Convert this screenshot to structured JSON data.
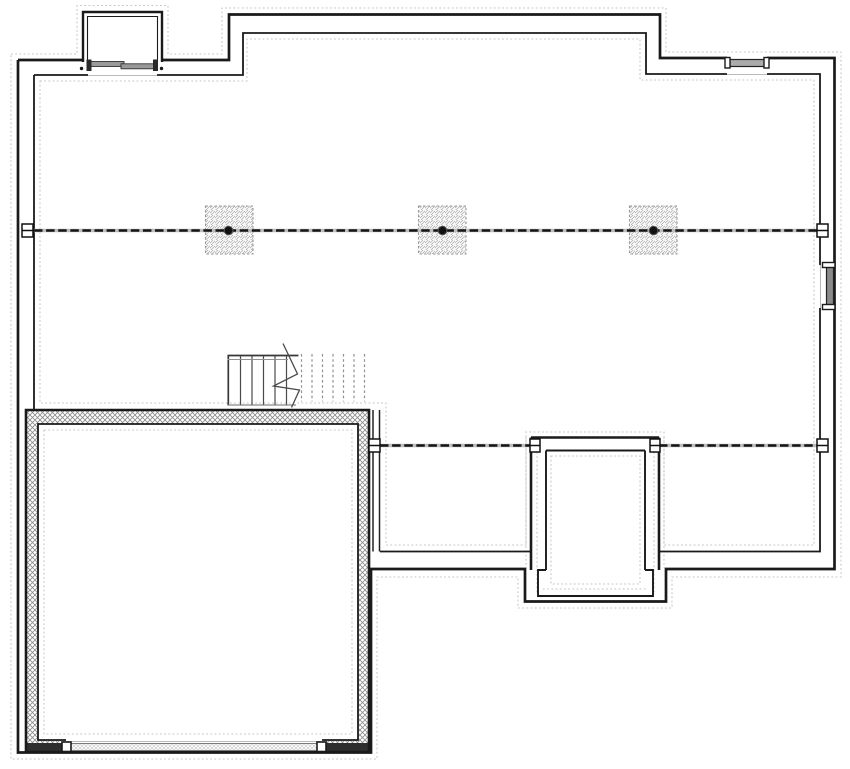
{
  "meta": {
    "title": "basement-foundation-plan",
    "canvas": {
      "width": 850,
      "height": 769
    },
    "background": "#ffffff"
  },
  "palette": {
    "ink": "#1a1a1a",
    "beam_dash": "#141414",
    "beam_under": "#bdbdbd",
    "footing": "#c6c6c6",
    "opening_line": "#bbbbbb",
    "hatch_dark": "#8a8a8a",
    "hatch_light": "#b5b5b5",
    "white": "#ffffff"
  },
  "plan": {
    "shapes": [
      {
        "name": "footing-outer",
        "type": "path",
        "d": "M11,54 H77 V5.5 H168 V54 H222 V8 H666 V52 H841 V577 H672 V608 H518 V577 H377 V759 H11 Z",
        "stroke": "#c6c6c6",
        "sw": 1.1,
        "dash": "1.8 2.4",
        "fill": "none"
      },
      {
        "name": "footing-inner",
        "type": "path",
        "d": "M40,81 H247 V39 H640 V80 H814 V545 H664 V432 H526 V545 H386 V403 H40 Z",
        "stroke": "#c6c6c6",
        "sw": 1.1,
        "dash": "1.8 2.4",
        "fill": "none"
      },
      {
        "name": "footing-garage",
        "type": "path",
        "d": "M44,430 H352 V734 H44 Z",
        "stroke": "#c6c6c6",
        "sw": 1.1,
        "dash": "1.8 2.4",
        "fill": "none"
      },
      {
        "name": "footing-stoop-inner",
        "type": "path",
        "d": "M551,456 H640 V584 H551 Z M543,589 H648",
        "stroke": "#c6c6c6",
        "sw": 1.1,
        "dash": "1.8 2.4",
        "fill": "none"
      },
      {
        "name": "footing-stoop-walls",
        "type": "path",
        "d": "M537,452 V593 M654,452 V593 M526,437 V568 M664,437 V568",
        "stroke": "#c6c6c6",
        "sw": 1.1,
        "dash": "1.8 2.4",
        "fill": "none"
      },
      {
        "name": "garage-wall-hatch",
        "type": "path",
        "d": "M26,410 H369 V752 H26 Z M38,424 H358 V740 H38 Z",
        "fill": "url(#hatch-wall)",
        "fr": "evenodd",
        "stroke": "none"
      },
      {
        "name": "garage-door-flank-left",
        "type": "path",
        "d": "M26,743 H68 V752 H26 Z",
        "fill": "#2e2e2e",
        "stroke": "none"
      },
      {
        "name": "garage-door-flank-right",
        "type": "path",
        "d": "M320,743 H369 V752 H320 Z",
        "fill": "#2e2e2e",
        "stroke": "none"
      },
      {
        "name": "garage-wall-outer-line",
        "type": "path",
        "d": "M26,410 H369 V752 H26 Z",
        "stroke": "#1a1a1a",
        "sw": 2.6,
        "fill": "none"
      },
      {
        "name": "garage-wall-inner-line",
        "type": "path",
        "d": "M38,424 H358 V740 H38 Z",
        "stroke": "#1a1a1a",
        "sw": 1.8,
        "fill": "none"
      },
      {
        "name": "garage-door-clear",
        "type": "rect",
        "x": 66,
        "y": 738.5,
        "w": 256,
        "h": 12,
        "fill": "#ffffff",
        "stroke": "none"
      },
      {
        "name": "garage-door-sill-line",
        "type": "line",
        "x1": 66,
        "y1": 741.5,
        "x2": 322,
        "y2": 741.5,
        "stroke": "#bbbbbb",
        "sw": 1,
        "fill": "none"
      },
      {
        "name": "garage-door-panel",
        "type": "rect",
        "x": 70,
        "y": 743.5,
        "w": 248,
        "h": 7,
        "fill": "url(#hatch-door)",
        "stroke": "#7a7a7a",
        "sw": 1
      },
      {
        "name": "garage-door-jamb-left",
        "type": "rect",
        "x": 62,
        "y": 742,
        "w": 9,
        "h": 9.5,
        "fill": "#ffffff",
        "stroke": "#1a1a1a",
        "sw": 1.6
      },
      {
        "name": "garage-door-jamb-right",
        "type": "rect",
        "x": 317,
        "y": 742,
        "w": 9,
        "h": 9.5,
        "fill": "#ffffff",
        "stroke": "#1a1a1a",
        "sw": 1.6
      },
      {
        "name": "exterior-wall-outer",
        "type": "path",
        "d": "M18,60 H83 M162,60 H229 V14.5 H660 V58 H727 M767,58 H834.5 V569 H666 V601.5 H525 V569 H371 V752.5 H18 V60",
        "stroke": "#1a1a1a",
        "sw": 2.7,
        "fill": "none"
      },
      {
        "name": "exterior-wall-inner",
        "type": "path",
        "d": "M34,75 V410 M34,75 H88 M157,75 H243 V33 H646 V74 H727 M767,74 H820 V265 M820,308 V551.5 H659 M531,551.5 H380",
        "stroke": "#1a1a1a",
        "sw": 1.8,
        "fill": "none"
      },
      {
        "name": "garage-frame-wall",
        "type": "path",
        "d": "M373,410 V551.5 M379.5,410 V551.5",
        "stroke": "#222222",
        "sw": 1.5,
        "fill": "none"
      },
      {
        "name": "stoop-wall-outer",
        "type": "path",
        "d": "M531,437.5 H659 M531,437.5 V570 M659,437.5 V570",
        "stroke": "#1a1a1a",
        "sw": 2.6,
        "fill": "none"
      },
      {
        "name": "stoop-wall-inner",
        "type": "path",
        "d": "M546,450.5 H645 M546,450.5 V570 M645,450.5 V570 M546,570 H538 V596 H653 V570 H645",
        "stroke": "#1a1a1a",
        "sw": 1.9,
        "fill": "none"
      },
      {
        "name": "window-well-outline-outer",
        "type": "path",
        "d": "M83,62 V12 H162 V62",
        "stroke": "#1a1a1a",
        "sw": 2.4,
        "fill": "#ffffff"
      },
      {
        "name": "window-well-outline-inner",
        "type": "path",
        "d": "M87.5,62 V16.5 H157.5 V62",
        "stroke": "#1a1a1a",
        "sw": 1.1,
        "fill": "none"
      },
      {
        "name": "window-well-sill-line",
        "type": "line",
        "x1": 88,
        "y1": 75.5,
        "x2": 157,
        "y2": 75.5,
        "stroke": "#bbbbbb",
        "sw": 1.1,
        "fill": "none"
      },
      {
        "name": "well-window-sash-left",
        "type": "rect",
        "x": 90.5,
        "y": 61.5,
        "w": 33.5,
        "h": 5,
        "fill": "#9a9a9a",
        "stroke": "#333333",
        "sw": 0.9
      },
      {
        "name": "well-window-sash-right",
        "type": "rect",
        "x": 121,
        "y": 63.8,
        "w": 33.5,
        "h": 5,
        "fill": "#9a9a9a",
        "stroke": "#333333",
        "sw": 0.9
      },
      {
        "name": "well-window-jamb-left",
        "type": "rect",
        "x": 86.5,
        "y": 59.5,
        "w": 5,
        "h": 11.5,
        "fill": "#2a2a2a",
        "stroke": "none"
      },
      {
        "name": "well-window-jamb-right",
        "type": "rect",
        "x": 153,
        "y": 59.5,
        "w": 5,
        "h": 11.5,
        "fill": "#2a2a2a",
        "stroke": "none"
      },
      {
        "name": "well-marker-dot-left",
        "type": "circle",
        "cx": 81.5,
        "cy": 68.5,
        "r": 1.7,
        "fill": "#1a1a1a",
        "stroke": "none"
      },
      {
        "name": "well-marker-dot-right",
        "type": "circle",
        "cx": 161.5,
        "cy": 68.5,
        "r": 1.7,
        "fill": "#1a1a1a",
        "stroke": "none"
      },
      {
        "name": "window-top-sill-line",
        "type": "line",
        "x1": 727,
        "y1": 74.5,
        "x2": 767,
        "y2": 74.5,
        "stroke": "#bbbbbb",
        "sw": 1.1,
        "fill": "none"
      },
      {
        "name": "window-top-bar",
        "type": "rect",
        "x": 727,
        "y": 59.5,
        "w": 40,
        "h": 7,
        "fill": "#ababab",
        "stroke": "#222222",
        "sw": 1.2
      },
      {
        "name": "window-top-cap-left",
        "type": "rect",
        "x": 725,
        "y": 57.5,
        "w": 5,
        "h": 10.5,
        "fill": "#ffffff",
        "stroke": "#1a1a1a",
        "sw": 1.4
      },
      {
        "name": "window-top-cap-right",
        "type": "rect",
        "x": 764,
        "y": 57.5,
        "w": 5,
        "h": 10.5,
        "fill": "#ffffff",
        "stroke": "#1a1a1a",
        "sw": 1.4
      },
      {
        "name": "window-right-sill-line",
        "type": "line",
        "x1": 820.5,
        "y1": 265,
        "x2": 820.5,
        "y2": 308,
        "stroke": "#bbbbbb",
        "sw": 1.1,
        "fill": "none"
      },
      {
        "name": "window-right-bar",
        "type": "rect",
        "x": 826.5,
        "y": 266.5,
        "w": 7,
        "h": 40.5,
        "fill": "#8a8a8a",
        "stroke": "#222222",
        "sw": 1.2
      },
      {
        "name": "window-right-cap-top",
        "type": "rect",
        "x": 822.5,
        "y": 262.5,
        "w": 12.5,
        "h": 5,
        "fill": "#ffffff",
        "stroke": "#1a1a1a",
        "sw": 1.4
      },
      {
        "name": "window-right-cap-bottom",
        "type": "rect",
        "x": 822.5,
        "y": 304.5,
        "w": 12.5,
        "h": 5,
        "fill": "#ffffff",
        "stroke": "#1a1a1a",
        "sw": 1.4
      },
      {
        "name": "column-pad-1",
        "type": "rect",
        "x": 205.5,
        "y": 206,
        "w": 47.5,
        "h": 48,
        "fill": "url(#hatch-col)",
        "stroke": "#9a9a9a",
        "sw": 1.1,
        "dash": "2.5 2"
      },
      {
        "name": "column-pad-2",
        "type": "rect",
        "x": 418.5,
        "y": 206,
        "w": 47.5,
        "h": 48,
        "fill": "url(#hatch-col)",
        "stroke": "#9a9a9a",
        "sw": 1.1,
        "dash": "2.5 2"
      },
      {
        "name": "column-pad-3",
        "type": "rect",
        "x": 629.5,
        "y": 206,
        "w": 47.5,
        "h": 48,
        "fill": "url(#hatch-col)",
        "stroke": "#9a9a9a",
        "sw": 1.1,
        "dash": "2.5 2"
      },
      {
        "name": "beam-main-underlay",
        "type": "line",
        "x1": 34,
        "y1": 230.5,
        "x2": 820,
        "y2": 230.5,
        "stroke": "#bdbdbd",
        "sw": 3.4,
        "fill": "none"
      },
      {
        "name": "beam-main",
        "type": "line",
        "x1": 34,
        "y1": 230.5,
        "x2": 820,
        "y2": 230.5,
        "stroke": "#141414",
        "sw": 2.6,
        "dash": "8.5 3.6",
        "fill": "none"
      },
      {
        "name": "beam-rear-underlay",
        "type": "path",
        "d": "M380,445.5 H531 M659,445.5 H818",
        "stroke": "#bdbdbd",
        "sw": 3.4,
        "fill": "none"
      },
      {
        "name": "beam-rear",
        "type": "path",
        "d": "M380,445.5 H531 M659,445.5 H818",
        "stroke": "#141414",
        "sw": 2.6,
        "dash": "8.5 3.6",
        "fill": "none"
      },
      {
        "name": "column-post-1",
        "type": "circle",
        "cx": 228.5,
        "cy": 230.5,
        "r": 4.3,
        "fill": "#111111",
        "stroke": "#555555",
        "sw": 1
      },
      {
        "name": "column-post-2",
        "type": "circle",
        "cx": 442.5,
        "cy": 230.5,
        "r": 4.3,
        "fill": "#111111",
        "stroke": "#555555",
        "sw": 1
      },
      {
        "name": "column-post-3",
        "type": "circle",
        "cx": 653.5,
        "cy": 230.5,
        "r": 4.3,
        "fill": "#111111",
        "stroke": "#555555",
        "sw": 1
      },
      {
        "name": "beam-plate-main-left",
        "type": "path",
        "d": "M22,224 H33 V237 H22 Z M22,230.5 H33",
        "stroke": "#111111",
        "sw": 1.5,
        "fill": "#ffffff"
      },
      {
        "name": "beam-plate-main-right",
        "type": "path",
        "d": "M817,224 H828 V237 H817 Z M817,230.5 H828",
        "stroke": "#111111",
        "sw": 1.5,
        "fill": "#ffffff"
      },
      {
        "name": "beam-plate-rear-garage",
        "type": "path",
        "d": "M369,439 H380 V452 H369 Z M369,445.5 H380",
        "stroke": "#111111",
        "sw": 1.5,
        "fill": "#ffffff"
      },
      {
        "name": "beam-plate-stoop-left",
        "type": "path",
        "d": "M530,439 H540 V452 H530 Z M530,445.5 H540",
        "stroke": "#111111",
        "sw": 1.5,
        "fill": "#ffffff"
      },
      {
        "name": "beam-plate-stoop-right",
        "type": "path",
        "d": "M650,439 H660 V452 H650 Z M650,445.5 H660",
        "stroke": "#111111",
        "sw": 1.5,
        "fill": "#ffffff"
      },
      {
        "name": "beam-plate-rear-right",
        "type": "path",
        "d": "M817,439 H828 V452 H817 Z M817,445.5 H828",
        "stroke": "#111111",
        "sw": 1.5,
        "fill": "#ffffff"
      },
      {
        "name": "stair-treads",
        "type": "path",
        "d": "M240.5,356 V405 M252,356 V405 M263.5,356 V405 M275,356 V405 M286.5,356 V405",
        "stroke": "#4a4a4a",
        "sw": 1.2,
        "fill": "none"
      },
      {
        "name": "stair-top-edge",
        "type": "path",
        "d": "M227.5,355.5 H298.5 M228.3,355.5 V405.5",
        "stroke": "#383838",
        "sw": 1.7,
        "fill": "none"
      },
      {
        "name": "stair-top-edge-inner",
        "type": "line",
        "x1": 227.5,
        "y1": 359.5,
        "x2": 288,
        "y2": 359.5,
        "stroke": "#909090",
        "sw": 0.9,
        "fill": "none"
      },
      {
        "name": "stair-bottom-edge",
        "type": "line",
        "x1": 228,
        "y1": 405,
        "x2": 296,
        "y2": 405,
        "stroke": "#6a6a6a",
        "sw": 1,
        "fill": "none"
      },
      {
        "name": "stair-treads-hidden",
        "type": "path",
        "d": "M301.5,354 V401.5 M312,354 V401.5 M322.5,354 V401.5 M333,354 V401.5 M343.5,354 V401.5 M354,354 V401.5 M364.5,354 V401.5",
        "stroke": "#8f8f8f",
        "sw": 1.2,
        "dash": "2.6 2.6",
        "fill": "none"
      },
      {
        "name": "stair-break-line",
        "type": "polyline",
        "points": "283,343.5 297.5,374 273.5,386 299.5,390 291.5,407.5",
        "stroke": "#4a4a4a",
        "sw": 1.3,
        "fill": "none"
      }
    ]
  }
}
